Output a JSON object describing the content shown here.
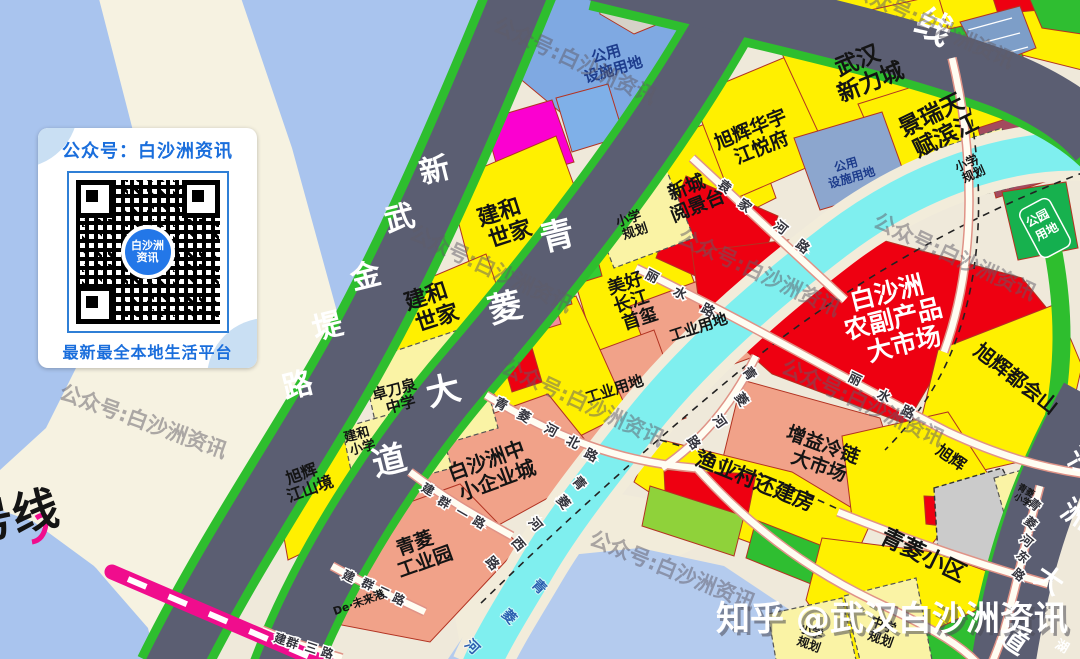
{
  "watermarks": {
    "gongzhonghao": "公众号:白沙洲资讯",
    "zhihu": "知乎 @武汉白沙洲资讯"
  },
  "qr_card": {
    "title": "公众号：白沙洲资讯",
    "center_l1": "白沙洲",
    "center_l2": "资讯",
    "footer": "最新最全本地生活平台"
  },
  "metro": {
    "line_label": "号线"
  },
  "badges": {
    "park": {
      "l1": "公园",
      "l2": "用地"
    }
  },
  "road_names": {
    "xinwujindi": [
      "新",
      "武",
      "金",
      "堤",
      "路"
    ],
    "qinglingdadao": [
      "青",
      "菱",
      "大",
      "道"
    ],
    "ringline_partial": "线",
    "baishazhou_dadao": [
      "沙",
      "洲",
      "大",
      "道"
    ],
    "hu": "湖",
    "yuanjiahe": [
      "袁",
      "家",
      "河",
      "路"
    ],
    "lishui": [
      "丽",
      "水",
      "路"
    ],
    "qinglinghebei": [
      "青",
      "菱",
      "河",
      "北",
      "路"
    ],
    "qinglinghexi": [
      "青",
      "菱",
      "河",
      "西",
      "路"
    ],
    "qinglinghe_rd": [
      "青",
      "菱",
      "河",
      "路"
    ],
    "qinglinghedong": [
      "青",
      "菱",
      "河",
      "东",
      "路"
    ],
    "jianqunyi": [
      "建",
      "群",
      "一",
      "路"
    ],
    "jianquner": [
      "建",
      "群",
      "二",
      "路"
    ],
    "jianqunsan": [
      "建",
      "群",
      "三",
      "路"
    ],
    "river": [
      "青",
      "菱",
      "河"
    ]
  },
  "parcels": {
    "gongyong": {
      "l1": "公用",
      "l2": "设施用地"
    },
    "jianhe": {
      "l1": "建和",
      "l2": "世家"
    },
    "zhuodaoquan": {
      "l1": "卓刀泉",
      "l2": "中学"
    },
    "jianhexiaoxue": {
      "l1": "建和",
      "l2": "小学"
    },
    "xuhui_jiangshanjing": {
      "l1": "旭辉",
      "l2": "江山境"
    },
    "wuhanxinlicheng": {
      "l1": "武汉",
      "l2": "新力城"
    },
    "jingrui": {
      "l1": "景瑞天",
      "l2": "赋滨江"
    },
    "xuhui_huayu": {
      "l1": "旭辉华宇",
      "l2": "江悦府"
    },
    "xincheng": {
      "l1": "新城",
      "l2": "阅景台"
    },
    "xiaoxueguihua": {
      "l1": "小学",
      "l2": "规划"
    },
    "zhongxueguihua": {
      "l1": "中学",
      "l2": "规划"
    },
    "meihao": {
      "l1": "美好",
      "l2": "长江",
      "l3": "首玺"
    },
    "gongye": "工业用地",
    "shichang": {
      "l1": "白沙洲",
      "l2": "农副产品",
      "l3": "大市场"
    },
    "zhongxiaoqiye": {
      "l1": "白沙洲中",
      "l2": "小企业城"
    },
    "qingling_gongyeyuan": {
      "l1": "青菱",
      "l2": "工业园"
    },
    "de_weilaigang": "De·未来港",
    "zengyi": {
      "l1": "增益冷链",
      "l2": "大市场"
    },
    "yuyecun": "渔业村还建房",
    "xuhui_duhuishan": "旭辉都会山",
    "xuhui": "旭辉",
    "qinglingxiaoqu": "青菱小区",
    "qinglingxiaoxue": {
      "l1": "青菱",
      "l2": "小学"
    }
  }
}
